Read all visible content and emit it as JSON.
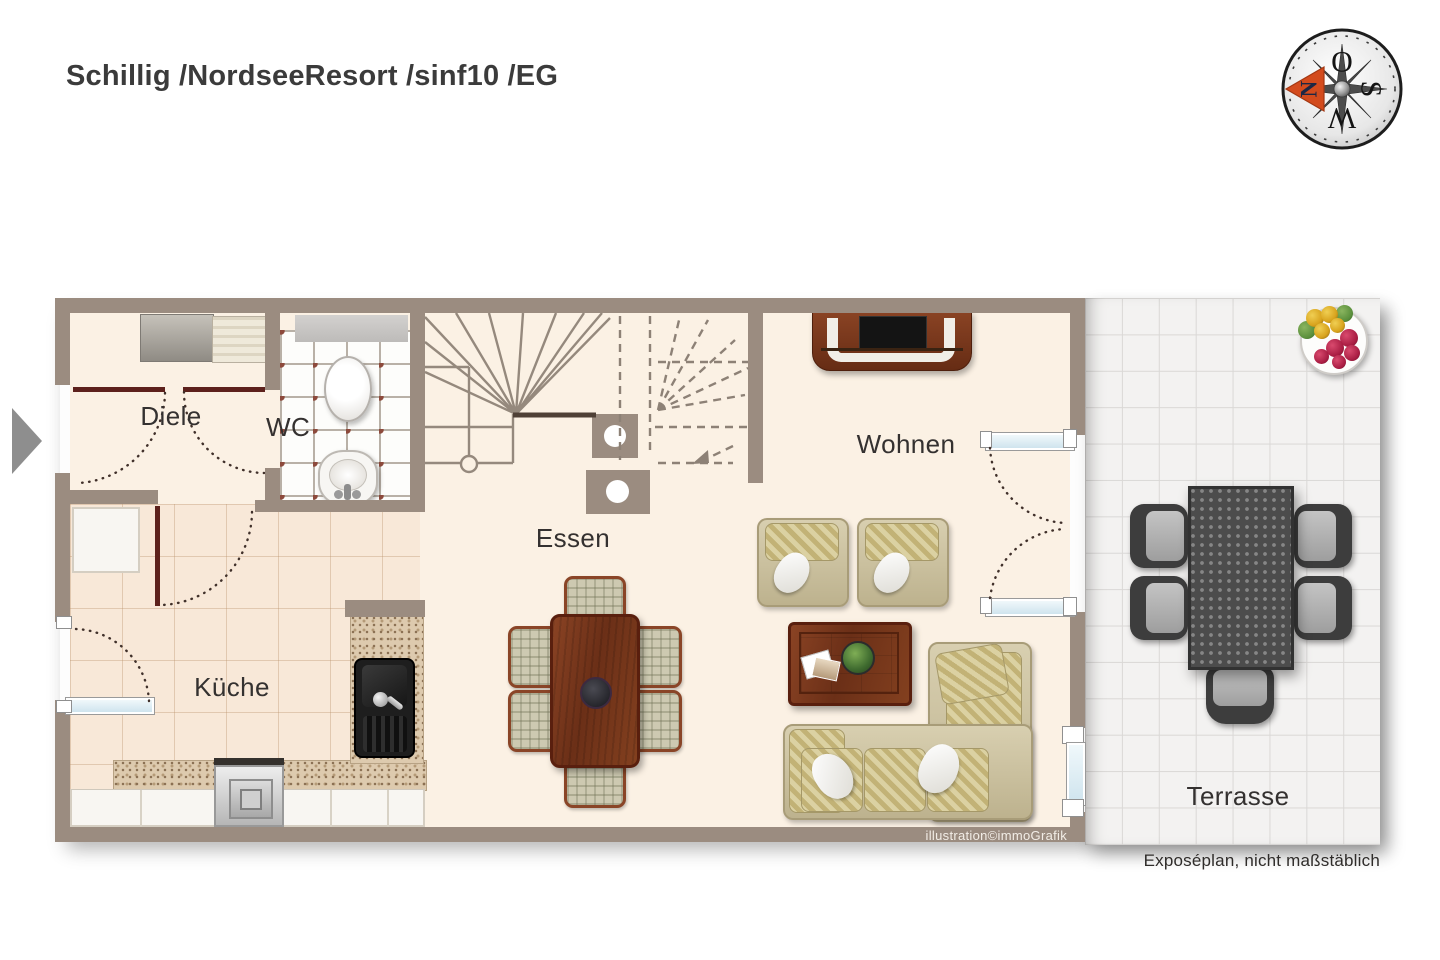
{
  "title": "Schillig /NordseeResort /sinf10 /EG",
  "compass": {
    "north": "N",
    "east": "O",
    "south": "S",
    "west": "W"
  },
  "rooms": {
    "diele": "Diele",
    "wc": "WC",
    "essen": "Essen",
    "wohnen": "Wohnen",
    "kueche": "Küche",
    "terrasse": "Terrasse"
  },
  "credits": {
    "illustration": "illustration©immoGrafik",
    "disclaimer": "Exposéplan, nicht maßstäblich"
  },
  "furniture_symbols": [
    "wardrobe",
    "toilet",
    "washbasin",
    "staircase",
    "dining-table",
    "dining-chair",
    "kitchen-counter",
    "stove",
    "kitchen-sink",
    "tv-sideboard",
    "armchair",
    "coffee-table",
    "corner-sofa",
    "patio-table",
    "patio-chair",
    "flower-pot",
    "entrance-arrow"
  ],
  "colors": {
    "wall": "#9b8c80",
    "floor": "#fbf1e4",
    "kitchen_tile": "#f8e8d8",
    "terrace_tile": "#f3f2f1",
    "door_leaf": "#5d211c",
    "glazing": "#cfe4ee",
    "compass_arrow": "#d34b1d"
  }
}
